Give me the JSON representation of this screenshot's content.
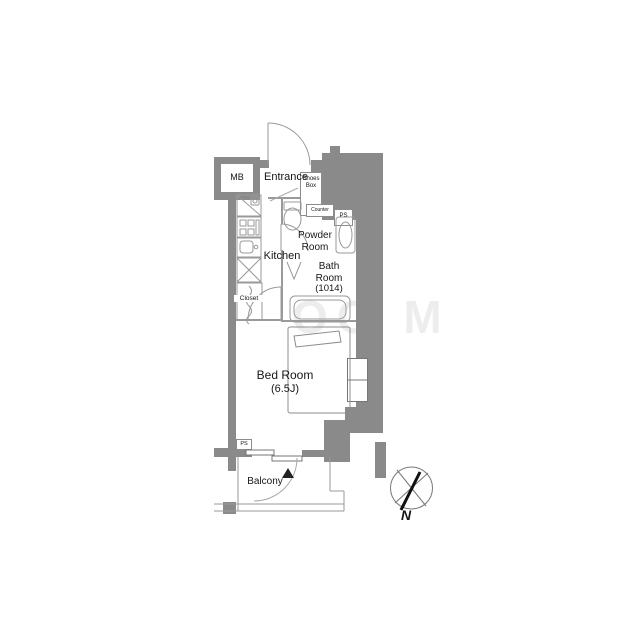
{
  "plan": {
    "rooms": {
      "mb": "MB",
      "entrance": "Entrance",
      "shoes_box_line1": "Shoes",
      "shoes_box_line2": "Box",
      "counter": "Counter",
      "ps_upper": "PS",
      "powder_line1": "Powder",
      "powder_line2": "Room",
      "kitchen": "Kitchen",
      "closet": "Closet",
      "bath_line1": "Bath",
      "bath_line2": "Room",
      "bath_line3": "(1014)",
      "bedroom_line1": "Bed Room",
      "bedroom_line2": "(6.5J)",
      "ps_lower": "PS",
      "balcony": "Balcony"
    },
    "compass": {
      "north": "N"
    },
    "watermark": "OO M",
    "colors": {
      "wall": "#8a8a8a",
      "fixture_line": "#999999",
      "text": "#161616",
      "watermark": "#ededed",
      "north_marker": "#111111",
      "background": "#ffffff"
    }
  }
}
